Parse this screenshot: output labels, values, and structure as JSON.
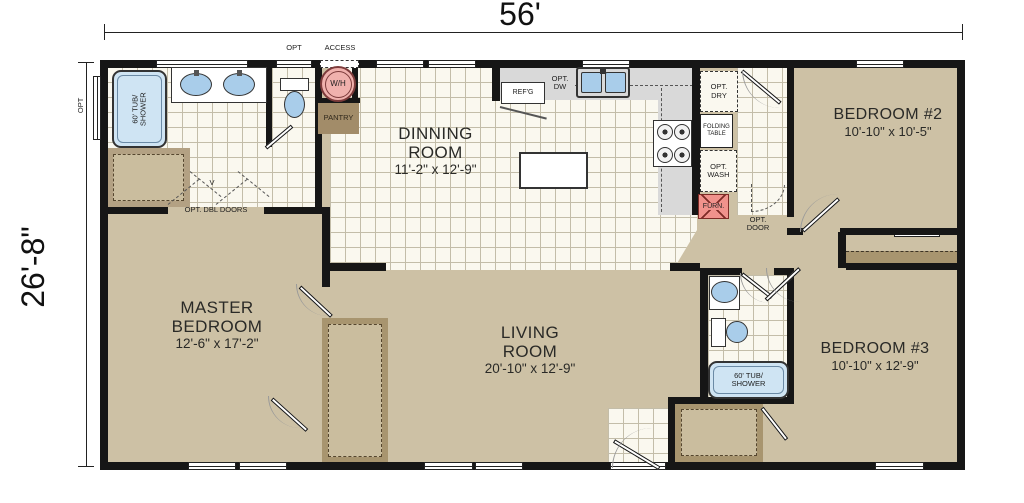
{
  "dimensions": {
    "width": "56'",
    "height": "26'-8\""
  },
  "rooms": {
    "master_bedroom": {
      "line1": "MASTER",
      "line2": "BEDROOM",
      "size": "12'-6\" x 17'-2\""
    },
    "dining_room": {
      "line1": "DINNING",
      "line2": "ROOM",
      "size": "11'-2\" x 12'-9\""
    },
    "living_room": {
      "line1": "LIVING",
      "line2": "ROOM",
      "size": "20'-10\" x 12'-9\""
    },
    "bedroom2": {
      "name": "BEDROOM #2",
      "size": "10'-10\" x 10'-5\""
    },
    "bedroom3": {
      "name": "BEDROOM #3",
      "size": "10'-10\" x 12'-9\""
    }
  },
  "labels": {
    "opt_window": "OPT",
    "opt_toilet": "OPT",
    "access": "ACCESS",
    "water_heater": "W/H",
    "pantry": "PANTRY",
    "tub1_line1": "60' TUB/",
    "tub1_line2": "SHOWER",
    "opt_dbl_doors": "OPT. DBL DOORS",
    "v_mark": "V",
    "refrigerator": "REF'G",
    "opt_dw_line1": "OPT.",
    "opt_dw_line2": "DW",
    "opt_dry_line1": "OPT.",
    "opt_dry_line2": "DRY",
    "folding_line1": "FOLDING",
    "folding_line2": "TABLE",
    "opt_wash_line1": "OPT.",
    "opt_wash_line2": "WASH",
    "furnace": "FURN.",
    "opt_door_line1": "OPT.",
    "opt_door_line2": "DOOR",
    "tub2_line1": "60' TUB/",
    "tub2_line2": "SHOWER"
  },
  "colors": {
    "floor-tan": "#cdc1a5",
    "tile-bg": "#faf8ef",
    "tile-line": "#c3bda9",
    "closet-dark": "#a8956f",
    "closet-mid": "#b3a183",
    "closet-light": "#cabd9e",
    "counter": "#d9d9d9",
    "tub-blue": "#cfe4f3",
    "fixture-blue": "#a9cdea",
    "wh-pink": "#f0b1ad",
    "furn-red": "#f0928c",
    "wall": "#161616"
  }
}
